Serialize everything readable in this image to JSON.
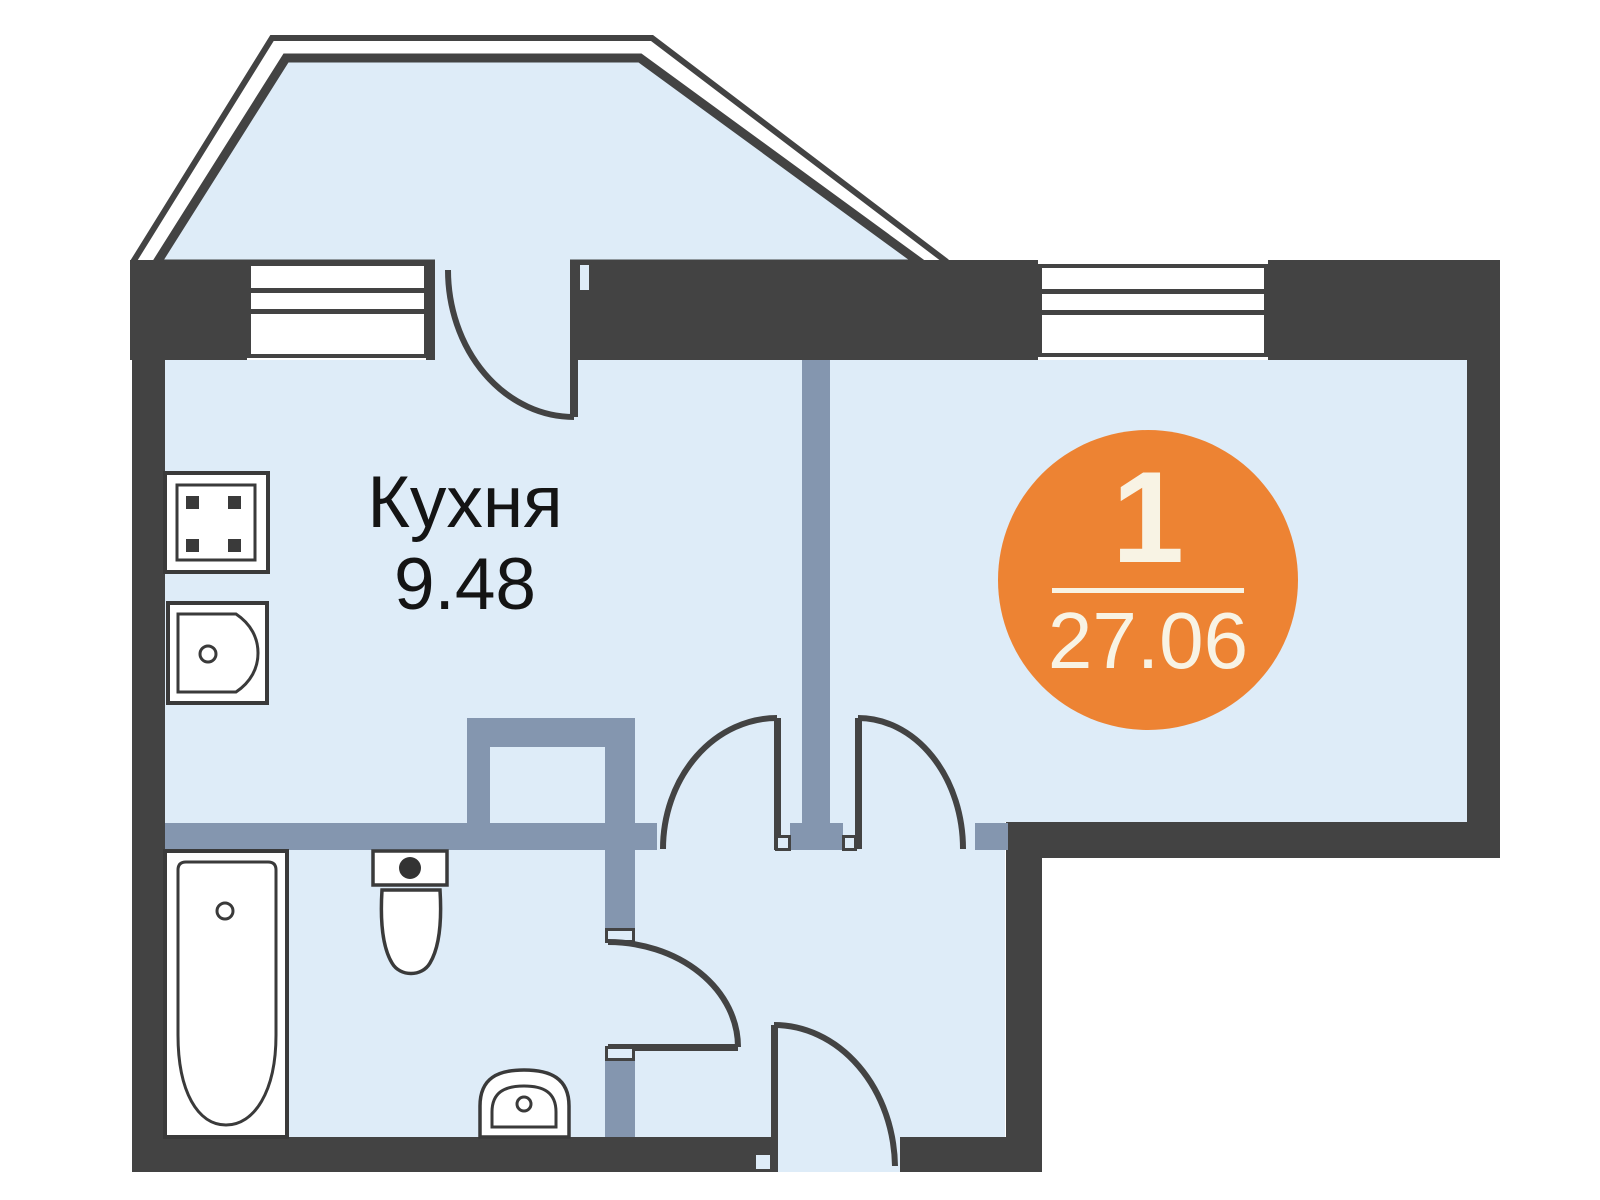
{
  "kitchen": {
    "name": "Кухня",
    "area": "9.48"
  },
  "badge": {
    "room_count": "1",
    "total_area": "27.06"
  },
  "colors": {
    "wall": "#434343",
    "partition": "#8496AF",
    "floor": "#DEECF8",
    "badge_background": "#ED8333",
    "badge_text": "#F8F3E4",
    "label_text": "#141414",
    "fixture_fill": "#FFFFFF",
    "fixture_outline": "#3A3A3A",
    "background": "#FFFFFF"
  },
  "fixtures": [
    "stove-icon",
    "kitchen-sink-icon",
    "bathtub-icon",
    "toilet-icon",
    "washbasin-icon"
  ],
  "features": [
    "bay-window",
    "kitchen-window",
    "living-room-window",
    "balcony-door",
    "kitchen-door",
    "living-room-door",
    "bathroom-door",
    "entrance-door"
  ]
}
